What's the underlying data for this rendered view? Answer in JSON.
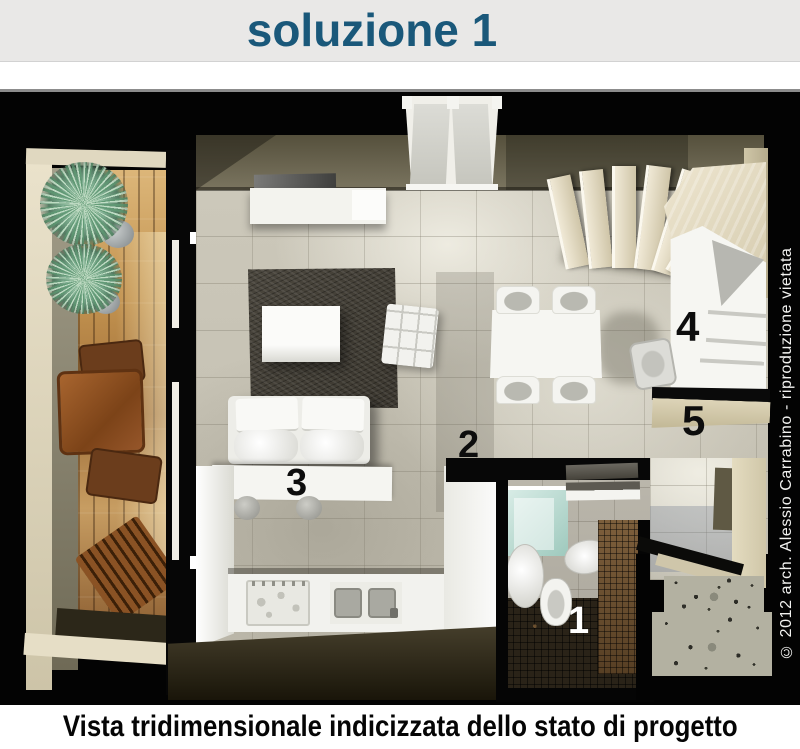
{
  "header": {
    "title": "soluzione 1"
  },
  "plan": {
    "credit": "© 2012 arch. Alessio Carrabino - riproduzione vietata",
    "labels": [
      {
        "text": "1",
        "color": "#ffffff"
      },
      {
        "text": "2",
        "color": "#111111"
      },
      {
        "text": "3",
        "color": "#111111"
      },
      {
        "text": "4",
        "color": "#111111"
      },
      {
        "text": "5",
        "color": "#111111"
      }
    ]
  },
  "caption": {
    "text": "Vista tridimensionale indicizzata dello stato di progetto"
  },
  "palette": {
    "header_bg": "#e9e8e7",
    "title_color": "#1a587a",
    "plan_bg": "#030303",
    "wall_olive": "#6e6852",
    "wall_beige": "#ddd5bc",
    "tile_floor": "#ccc8ba",
    "rug_charcoal": "#45413a",
    "wood_deck": "#b98a4e",
    "furniture_white": "#f4f4f0",
    "shower_aqua": "#bfe0d6",
    "mosaic_brown": "#6e5334",
    "terrazzo_gray": "#b3b1a1"
  }
}
